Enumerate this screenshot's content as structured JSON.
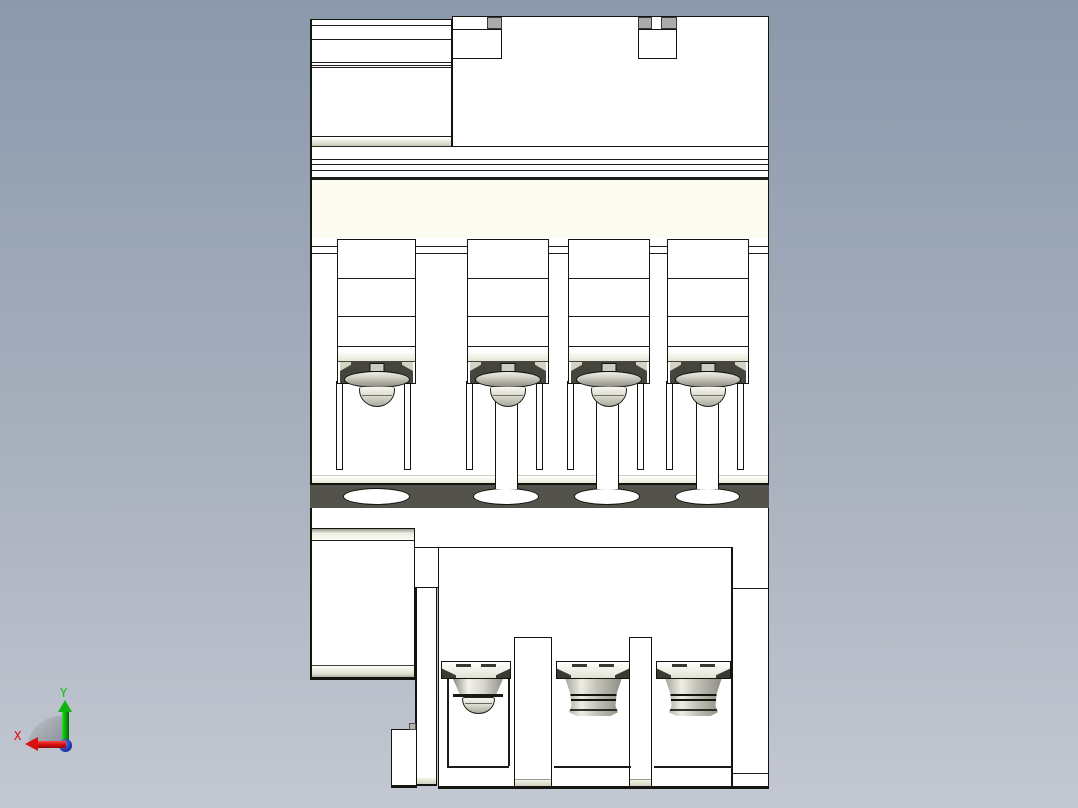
{
  "viewport": {
    "kind": "cad-3d-viewport",
    "background_gradient_top": "#8b99ac",
    "background_gradient_bottom": "#c3c8d2"
  },
  "model": {
    "body_color": "#ffffff",
    "edge_color": "#14140e",
    "slot_band_color": "#53534b",
    "accent_cream": "#fbfbef",
    "metal_light": "#f2f2ea",
    "metal_dark": "#8b8b81",
    "top_terminal_count": 4,
    "bottom_terminal_count": 3,
    "wire_opening_count": 4,
    "mounting_slot_count": 2
  },
  "triad": {
    "x_label": "X",
    "y_label": "Y",
    "x_color": "#d81010",
    "y_color": "#12b412",
    "z_color": "#2038b0"
  }
}
